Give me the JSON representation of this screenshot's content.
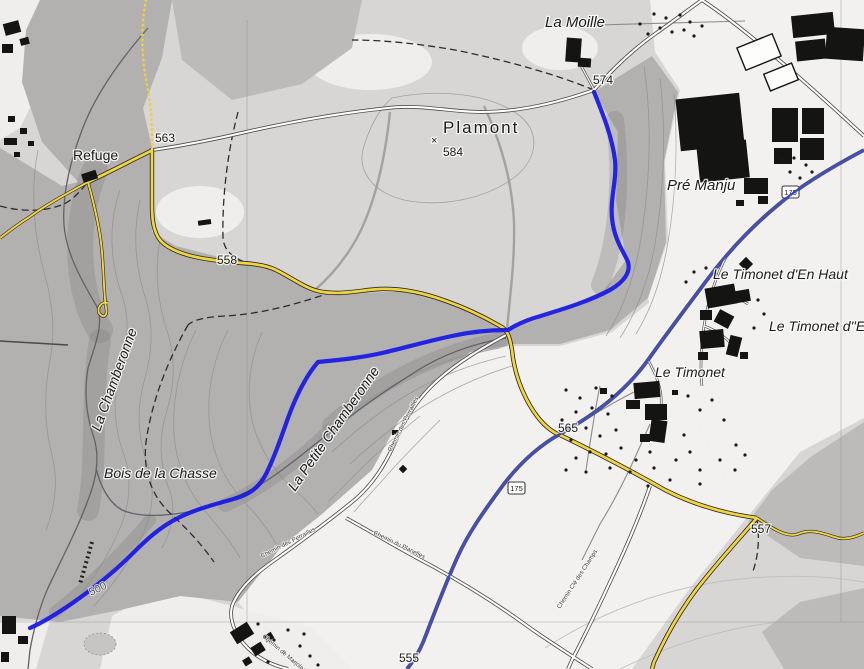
{
  "map": {
    "places": [
      {
        "text": "La Moille"
      },
      {
        "text": "Plamont"
      },
      {
        "text": "Pré Manju"
      },
      {
        "text": "Le Timonet d'En Haut"
      },
      {
        "text": "Le Timonet d''En"
      },
      {
        "text": "Le Timonet"
      },
      {
        "text": "Refuge"
      },
      {
        "text": "Bois de la Chasse"
      }
    ],
    "streams": [
      {
        "text": "La Chamberonne"
      },
      {
        "text": "La Petite Chamberonne"
      }
    ],
    "elevations": [
      {
        "text": "574"
      },
      {
        "text": "584"
      },
      {
        "text": "563"
      },
      {
        "text": "558"
      },
      {
        "text": "565"
      },
      {
        "text": "557"
      },
      {
        "text": "555"
      },
      {
        "text": "500"
      }
    ],
    "streets": [
      {
        "text": "Chemin des Perrailles"
      },
      {
        "text": "Chemin des Perrailles"
      },
      {
        "text": "Chemin du Planelles"
      },
      {
        "text": "Chemin de Marjolaz"
      },
      {
        "text": "Chemin Clé des Champs"
      }
    ],
    "route_shields": [
      {
        "text": "175"
      },
      {
        "text": "175"
      }
    ],
    "spot_symbol": "×",
    "colors": {
      "route_blue": "#1818e6",
      "cycle_route_blue": "#2e3ec4",
      "road_yellow": "#f2d43f",
      "forest_gray": "#b2b1af",
      "field_light": "#f2f1ef",
      "building_black": "#141413"
    }
  }
}
